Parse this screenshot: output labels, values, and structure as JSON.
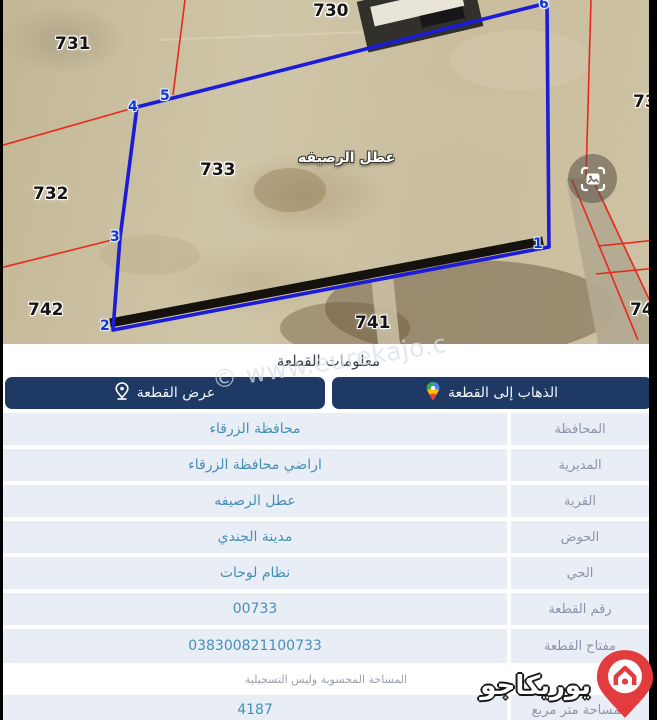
{
  "map": {
    "village_label": "عطل الرصيفه",
    "parcels": [
      {
        "id": "731"
      },
      {
        "id": "730"
      },
      {
        "id": "732"
      },
      {
        "id": "733"
      },
      {
        "id": "742"
      },
      {
        "id": "741"
      },
      {
        "id": "73"
      },
      {
        "id": "74"
      }
    ],
    "vertices": [
      {
        "n": "1"
      },
      {
        "n": "2"
      },
      {
        "n": "3"
      },
      {
        "n": "4"
      },
      {
        "n": "5"
      },
      {
        "n": "6"
      }
    ]
  },
  "info": {
    "title": "معلومات القطعة"
  },
  "tabs": {
    "view_label": "عرض القطعة",
    "goto_label": "الذهاب إلى القطعة"
  },
  "watermark": "© www.eurekajo.c",
  "table": {
    "rows": [
      {
        "label": "المحافظة",
        "value": "محافظة الزرقاء"
      },
      {
        "label": "المديرية",
        "value": "اراضي محافظة الزرقاء"
      },
      {
        "label": "القرية",
        "value": "عطل الرصيفه"
      },
      {
        "label": "الحوض",
        "value": "مدينة الجندي"
      },
      {
        "label": "الحي",
        "value": "نظام لوحات"
      },
      {
        "label": "رقم القطعة",
        "value": "00733"
      },
      {
        "label": "مفتاح القطعة",
        "value": "038300821100733"
      },
      {
        "label": "المساحة متر مربع",
        "value": "4187"
      }
    ],
    "note": "المساحة المحسوبة وليس التسجيلية"
  },
  "brand": {
    "name": "يوريكاجو"
  },
  "colors": {
    "tab_navy": "#1e3a64",
    "value_teal": "#4690b8",
    "label_gray": "#8a96a8",
    "cell_bg": "#e9edf5",
    "polygon_blue": "#1b1bd8",
    "cadastre_red": "#e8281e",
    "brand_red": "#e23c3f"
  }
}
